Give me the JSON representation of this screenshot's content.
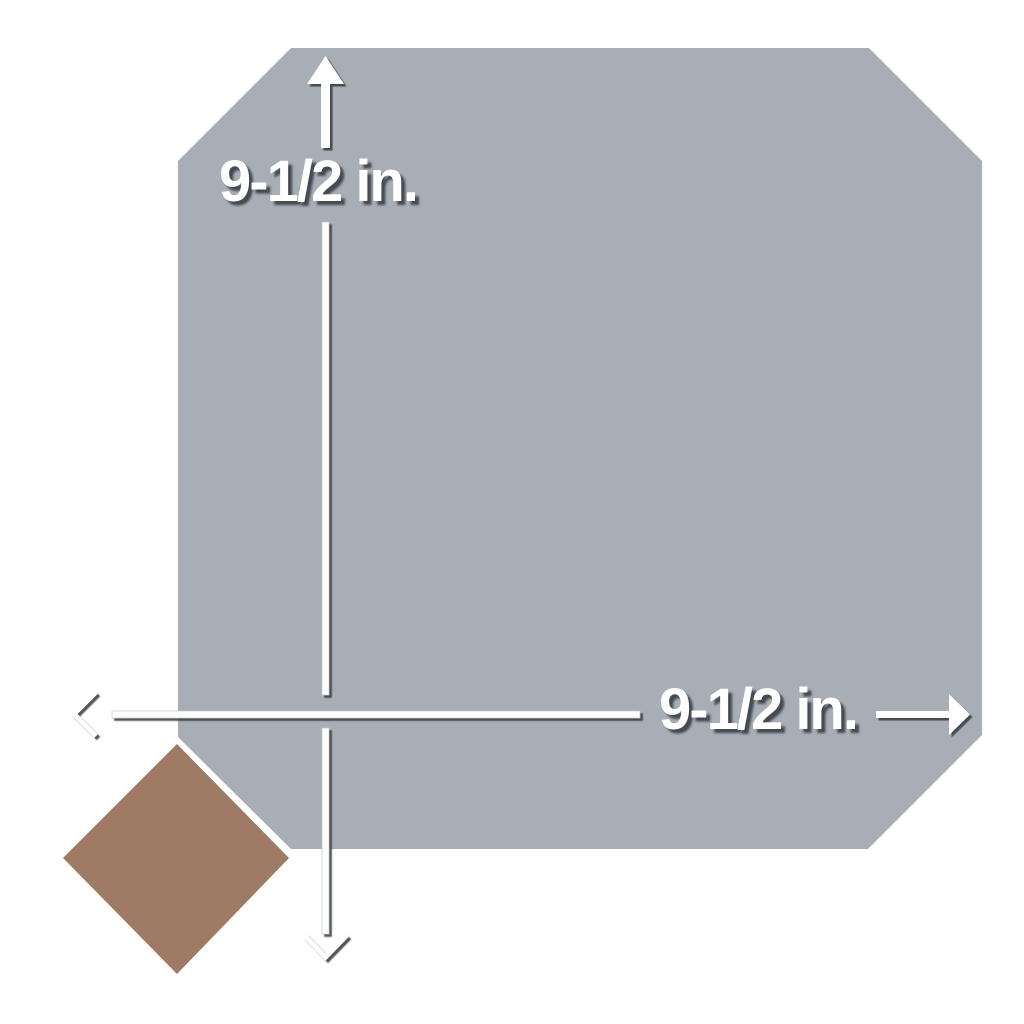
{
  "dimension_vertical": {
    "label": "9-1/2 in."
  },
  "dimension_horizontal": {
    "label": "9-1/2 in."
  },
  "colors": {
    "background": "#ffffff",
    "tile_fill": "#a8aeb6",
    "dot_fill": "#9f7a64",
    "line": "#ffffff",
    "shadow": "#343940"
  },
  "icons": {
    "vertical_head": "arrow-up-filled",
    "vertical_tail": "chevron-down-open",
    "horizontal_head": "arrow-right-filled",
    "horizontal_tail": "chevron-left-open"
  }
}
